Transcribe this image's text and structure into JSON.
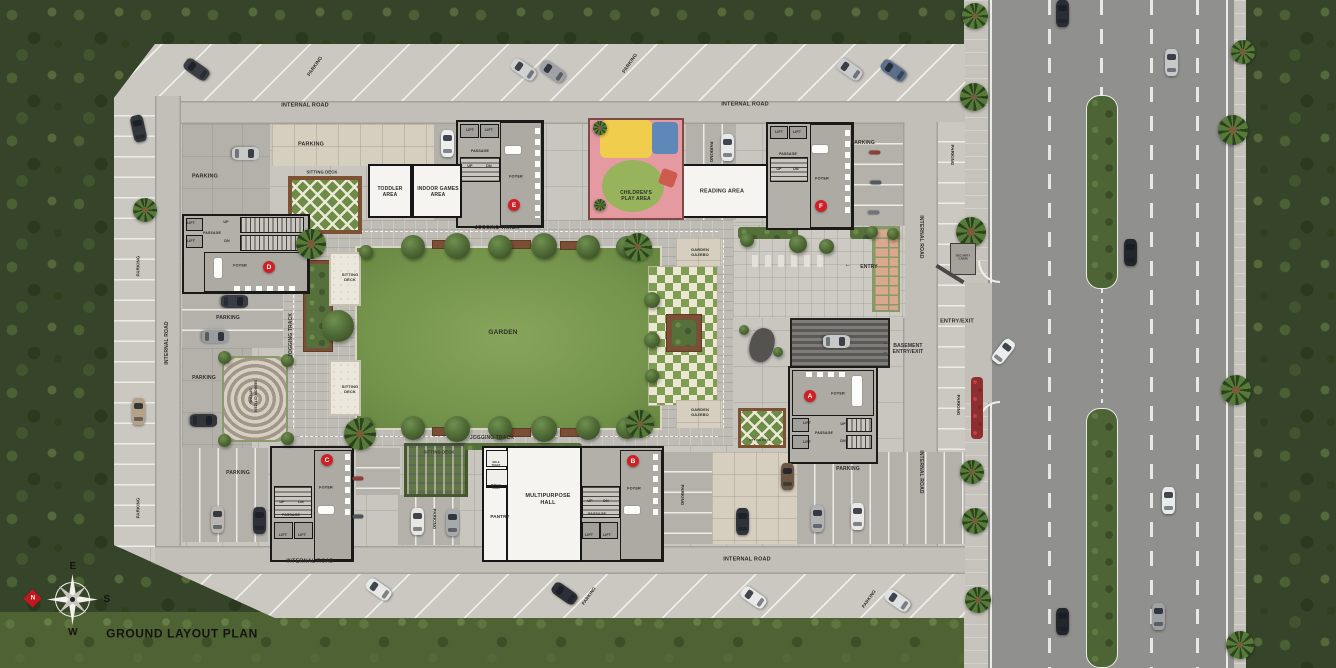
{
  "plan_title": "GROUND LAYOUT PLAN",
  "colors": {
    "badge_red": "#ce2127",
    "garden_green": "#7f9d52",
    "road_gray": "#90908e"
  },
  "blocks": [
    "A",
    "B",
    "C",
    "D",
    "E",
    "F"
  ],
  "labels": [
    {
      "t": "PARKING",
      "x": 316,
      "y": 67,
      "r": -55,
      "s": 4.8,
      "n": "label-parking"
    },
    {
      "t": "PARKING",
      "x": 631,
      "y": 64,
      "r": -55,
      "s": 4.8,
      "n": "label-parking"
    },
    {
      "t": "INTERNAL ROAD",
      "x": 305,
      "y": 106,
      "s": 5.5,
      "n": "label-internal-road"
    },
    {
      "t": "INTERNAL ROAD",
      "x": 745,
      "y": 105,
      "s": 5.5,
      "n": "label-internal-road"
    },
    {
      "t": "PARKING",
      "x": 205,
      "y": 177,
      "s": 5.5,
      "n": "label-parking"
    },
    {
      "t": "PARKING",
      "x": 311,
      "y": 145,
      "s": 5.5,
      "n": "label-parking"
    },
    {
      "t": "SITTING DECK",
      "x": 322,
      "y": 172,
      "s": 4.2,
      "n": "label-sitting-deck"
    },
    {
      "t": "TODDLER\nAREA",
      "x": 390,
      "y": 192,
      "s": 5,
      "n": "label-toddler-area"
    },
    {
      "t": "INDOOR GAMES\nAREA",
      "x": 438,
      "y": 192,
      "s": 5,
      "n": "label-indoor-games-area"
    },
    {
      "t": "LIFT",
      "x": 470,
      "y": 130,
      "s": 3.6,
      "n": "label-lift"
    },
    {
      "t": "LIFT",
      "x": 489,
      "y": 130,
      "s": 3.6,
      "n": "label-lift"
    },
    {
      "t": "PASSAGE",
      "x": 480,
      "y": 151,
      "s": 3.6,
      "n": "label-passage"
    },
    {
      "t": "UP",
      "x": 470,
      "y": 166,
      "s": 3.6,
      "n": "label-up"
    },
    {
      "t": "DN",
      "x": 489,
      "y": 166,
      "s": 3.6,
      "n": "label-dn"
    },
    {
      "t": "FOYER",
      "x": 516,
      "y": 177,
      "s": 3.8,
      "n": "label-foyer"
    },
    {
      "t": "JOGGING TRACK",
      "x": 497,
      "y": 228,
      "s": 5,
      "n": "label-jogging-track"
    },
    {
      "t": "CHILDREN'S\nPLAY AREA",
      "x": 636,
      "y": 196,
      "s": 5,
      "n": "label-childrens-play-area"
    },
    {
      "t": "PARKING",
      "x": 711,
      "y": 152,
      "r": 90,
      "s": 4.4,
      "n": "label-parking"
    },
    {
      "t": "READING AREA",
      "x": 722,
      "y": 192,
      "s": 5.5,
      "n": "label-reading-area"
    },
    {
      "t": "LIFT",
      "x": 779,
      "y": 132,
      "s": 3.6,
      "n": "label-lift"
    },
    {
      "t": "LIFT",
      "x": 797,
      "y": 132,
      "s": 3.6,
      "n": "label-lift"
    },
    {
      "t": "PASSAGE",
      "x": 788,
      "y": 154,
      "s": 3.6,
      "n": "label-passage"
    },
    {
      "t": "UP",
      "x": 779,
      "y": 169,
      "s": 3.6,
      "n": "label-up"
    },
    {
      "t": "DN",
      "x": 796,
      "y": 169,
      "s": 3.6,
      "n": "label-dn"
    },
    {
      "t": "FOYER",
      "x": 822,
      "y": 179,
      "s": 3.8,
      "n": "label-foyer"
    },
    {
      "t": "PARKING",
      "x": 863,
      "y": 143,
      "s": 5,
      "n": "label-parking"
    },
    {
      "t": "PARKING",
      "x": 952,
      "y": 155,
      "r": 90,
      "s": 4.4,
      "n": "label-parking"
    },
    {
      "t": "INTERNAL ROAD",
      "x": 921,
      "y": 237,
      "r": 90,
      "s": 5,
      "n": "label-internal-road"
    },
    {
      "t": "SECURITY\nCABIN",
      "x": 963,
      "y": 258,
      "s": 2.8,
      "n": "label-security-cabin"
    },
    {
      "t": "←",
      "x": 848,
      "y": 266,
      "s": 7,
      "n": "entry-arrow"
    },
    {
      "t": "ENTRY",
      "x": 869,
      "y": 267,
      "s": 5,
      "n": "label-entry"
    },
    {
      "t": "ENTRY/EXIT",
      "x": 957,
      "y": 322,
      "s": 5.5,
      "n": "label-entry-exit"
    },
    {
      "t": "BASEMENT\nENTRY/EXIT",
      "x": 908,
      "y": 349,
      "s": 5,
      "n": "label-basement-entry-exit"
    },
    {
      "t": "←",
      "x": 886,
      "y": 344,
      "s": 6,
      "n": "basement-arrow"
    },
    {
      "t": "←",
      "x": 886,
      "y": 353,
      "s": 6,
      "n": "basement-arrow"
    },
    {
      "t": "FOYER",
      "x": 838,
      "y": 394,
      "s": 3.8,
      "n": "label-foyer"
    },
    {
      "t": "LIFT",
      "x": 807,
      "y": 423,
      "s": 3.6,
      "n": "label-lift"
    },
    {
      "t": "LIFT",
      "x": 807,
      "y": 442,
      "s": 3.6,
      "n": "label-lift"
    },
    {
      "t": "PASSAGE",
      "x": 824,
      "y": 433,
      "s": 3.6,
      "n": "label-passage"
    },
    {
      "t": "UP",
      "x": 843,
      "y": 424,
      "s": 3.6,
      "n": "label-up"
    },
    {
      "t": "DN",
      "x": 843,
      "y": 441,
      "s": 3.6,
      "n": "label-dn"
    },
    {
      "t": "PARKING",
      "x": 848,
      "y": 469,
      "s": 5,
      "n": "label-parking"
    },
    {
      "t": "INTERNAL ROAD",
      "x": 921,
      "y": 472,
      "r": 90,
      "s": 5,
      "n": "label-internal-road"
    },
    {
      "t": "PARKING",
      "x": 958,
      "y": 405,
      "r": 90,
      "s": 4.4,
      "n": "label-parking"
    },
    {
      "t": "GARDEN",
      "x": 503,
      "y": 333,
      "s": 6.5,
      "n": "label-garden"
    },
    {
      "t": "GARDEN\nGAZEBO",
      "x": 700,
      "y": 252,
      "s": 4,
      "n": "label-garden-gazebo"
    },
    {
      "t": "GARDEN\nGAZEBO",
      "x": 700,
      "y": 412,
      "s": 4,
      "n": "label-garden-gazebo"
    },
    {
      "t": "SITTING\nDECK",
      "x": 350,
      "y": 277,
      "s": 4,
      "n": "label-sitting-deck"
    },
    {
      "t": "SITTING\nDECK",
      "x": 350,
      "y": 389,
      "s": 4,
      "n": "label-sitting-deck"
    },
    {
      "t": "JOGGING TRACK",
      "x": 291,
      "y": 335,
      "r": -90,
      "s": 5,
      "n": "label-jogging-track"
    },
    {
      "t": "JOGGING TRACK",
      "x": 492,
      "y": 438,
      "s": 5,
      "n": "label-jogging-track"
    },
    {
      "t": "SITTING DECK",
      "x": 760,
      "y": 441,
      "s": 3,
      "n": "label-sitting-deck"
    },
    {
      "t": "LIFT",
      "x": 191,
      "y": 223,
      "s": 3.6,
      "n": "label-lift"
    },
    {
      "t": "UP",
      "x": 226,
      "y": 222,
      "s": 3.6,
      "n": "label-up"
    },
    {
      "t": "PASSAGE",
      "x": 212,
      "y": 233,
      "s": 3.6,
      "n": "label-passage"
    },
    {
      "t": "LIFT",
      "x": 191,
      "y": 241,
      "s": 3.6,
      "n": "label-lift"
    },
    {
      "t": "DN",
      "x": 227,
      "y": 241,
      "s": 3.6,
      "n": "label-dn"
    },
    {
      "t": "FOYER",
      "x": 240,
      "y": 266,
      "s": 3.8,
      "n": "label-foyer"
    },
    {
      "t": "PARKING",
      "x": 228,
      "y": 318,
      "s": 5,
      "n": "label-parking"
    },
    {
      "t": "PARKING",
      "x": 204,
      "y": 378,
      "s": 5,
      "n": "label-parking"
    },
    {
      "t": "SENIOR CITIZEN\nSITTING",
      "x": 253,
      "y": 396,
      "r": 90,
      "s": 3.8,
      "n": "label-senior-citizen-sitting"
    },
    {
      "t": "PARKING",
      "x": 138,
      "y": 266,
      "r": -90,
      "s": 4.4,
      "n": "label-parking"
    },
    {
      "t": "PARKING",
      "x": 138,
      "y": 508,
      "r": -90,
      "s": 4.4,
      "n": "label-parking"
    },
    {
      "t": "INTERNAL ROAD",
      "x": 167,
      "y": 343,
      "r": -90,
      "s": 5,
      "n": "label-internal-road"
    },
    {
      "t": "PARKING",
      "x": 238,
      "y": 473,
      "s": 5,
      "n": "label-parking"
    },
    {
      "t": "FOYER",
      "x": 326,
      "y": 488,
      "s": 3.8,
      "n": "label-foyer"
    },
    {
      "t": "UP",
      "x": 282,
      "y": 502,
      "s": 3.6,
      "n": "label-up"
    },
    {
      "t": "DN",
      "x": 301,
      "y": 502,
      "s": 3.6,
      "n": "label-dn"
    },
    {
      "t": "PASSAGE",
      "x": 291,
      "y": 515,
      "s": 3.6,
      "n": "label-passage"
    },
    {
      "t": "LIFT",
      "x": 283,
      "y": 535,
      "s": 3.6,
      "n": "label-lift"
    },
    {
      "t": "LIFT",
      "x": 302,
      "y": 535,
      "s": 3.6,
      "n": "label-lift"
    },
    {
      "t": "SITTING DECK",
      "x": 439,
      "y": 452,
      "s": 4.2,
      "n": "label-sitting-deck"
    },
    {
      "t": "PARKING",
      "x": 434,
      "y": 519,
      "r": 90,
      "s": 4.4,
      "n": "label-parking"
    },
    {
      "t": "PANTRY",
      "x": 500,
      "y": 517,
      "s": 4.6,
      "n": "label-pantry"
    },
    {
      "t": "MALE\nTOILET",
      "x": 496,
      "y": 464,
      "s": 2.4,
      "n": "label-male-toilet"
    },
    {
      "t": "FEMALE\nTOILET",
      "x": 496,
      "y": 487,
      "s": 2.4,
      "n": "label-female-toilet"
    },
    {
      "t": "MULTIPURPOSE\nHALL",
      "x": 548,
      "y": 500,
      "s": 5.5,
      "n": "label-multipurpose-hall"
    },
    {
      "t": "INTERNAL ROAD",
      "x": 310,
      "y": 562,
      "s": 5.5,
      "n": "label-internal-road"
    },
    {
      "t": "INTERNAL ROAD",
      "x": 747,
      "y": 560,
      "s": 5.5,
      "n": "label-internal-road"
    },
    {
      "t": "FOYER",
      "x": 634,
      "y": 489,
      "s": 3.8,
      "n": "label-foyer"
    },
    {
      "t": "UP",
      "x": 590,
      "y": 501,
      "s": 3.6,
      "n": "label-up"
    },
    {
      "t": "DN",
      "x": 606,
      "y": 501,
      "s": 3.6,
      "n": "label-dn"
    },
    {
      "t": "PASSAGE",
      "x": 597,
      "y": 514,
      "s": 3.6,
      "n": "label-passage"
    },
    {
      "t": "LIFT",
      "x": 589,
      "y": 535,
      "s": 3.6,
      "n": "label-lift"
    },
    {
      "t": "LIFT",
      "x": 607,
      "y": 535,
      "s": 3.6,
      "n": "label-lift"
    },
    {
      "t": "PARKING",
      "x": 682,
      "y": 495,
      "r": 90,
      "s": 4.4,
      "n": "label-parking"
    },
    {
      "t": "PARKING",
      "x": 589,
      "y": 596,
      "r": -55,
      "s": 4.4,
      "n": "label-parking"
    },
    {
      "t": "PARKING",
      "x": 869,
      "y": 599,
      "r": -55,
      "s": 4.4,
      "n": "label-parking"
    },
    {
      "t": "GROUND LAYOUT PLAN",
      "x": 182,
      "y": 634,
      "s": 12,
      "w": 800,
      "c": "#141414",
      "ls": 0.6,
      "n": "plan-title"
    },
    {
      "t": "E",
      "x": 73,
      "y": 567,
      "s": 10,
      "c": "#15130f",
      "n": "compass-e"
    },
    {
      "t": "S",
      "x": 107,
      "y": 600,
      "s": 10,
      "c": "#15130f",
      "n": "compass-s"
    },
    {
      "t": "W",
      "x": 73,
      "y": 633,
      "s": 10,
      "c": "#15130f",
      "n": "compass-w"
    },
    {
      "t": "N",
      "x": 33,
      "y": 599,
      "s": 6,
      "c": "#ffffff",
      "n": "compass-n"
    }
  ],
  "badges": [
    {
      "l": "A",
      "x": 810,
      "y": 396
    },
    {
      "l": "B",
      "x": 633,
      "y": 461
    },
    {
      "l": "C",
      "x": 327,
      "y": 460
    },
    {
      "l": "D",
      "x": 269,
      "y": 267
    },
    {
      "l": "E",
      "x": 514,
      "y": 205
    },
    {
      "l": "F",
      "x": 821,
      "y": 206
    }
  ],
  "cars": [
    [
      196,
      69,
      -55,
      "#3a3d42"
    ],
    [
      523,
      69,
      -55,
      "#cfd1d2"
    ],
    [
      552,
      71,
      -55,
      "#9fa2a6"
    ],
    [
      849,
      69,
      -55,
      "#c9cbcc"
    ],
    [
      893,
      70,
      -55,
      "#5b6f8a"
    ],
    [
      138,
      128,
      -12,
      "#33363b"
    ],
    [
      138,
      411,
      0,
      "#b5a286"
    ],
    [
      245,
      153,
      90,
      "#c8c9c9"
    ],
    [
      447,
      143,
      0,
      "#eceeee"
    ],
    [
      727,
      147,
      0,
      "#e8e9e9"
    ],
    [
      234,
      301,
      90,
      "#3a3e44"
    ],
    [
      215,
      336,
      90,
      "#9a9d9f"
    ],
    [
      203,
      420,
      90,
      "#32363b"
    ],
    [
      217,
      519,
      0,
      "#b9b6b1"
    ],
    [
      259,
      520,
      0,
      "#2e3238"
    ],
    [
      417,
      521,
      0,
      "#e8e7e4"
    ],
    [
      452,
      522,
      0,
      "#a7a9ab"
    ],
    [
      742,
      521,
      0,
      "#2f3339"
    ],
    [
      787,
      476,
      0,
      "#6b5744"
    ],
    [
      817,
      518,
      0,
      "#b0b2b4"
    ],
    [
      857,
      516,
      0,
      "#e9e8e5"
    ],
    [
      836,
      341,
      90,
      "#c7c8c9"
    ],
    [
      378,
      589,
      -55,
      "#e6e7e7"
    ],
    [
      564,
      593,
      -55,
      "#2c3036"
    ],
    [
      753,
      597,
      -55,
      "#e9e9e8"
    ],
    [
      897,
      600,
      -55,
      "#dfe0e0"
    ],
    [
      1062,
      13,
      0,
      "#2a2d33"
    ],
    [
      1171,
      62,
      0,
      "#c6c8ca"
    ],
    [
      1130,
      252,
      0,
      "#23262b"
    ],
    [
      1003,
      351,
      38,
      "#eceded"
    ],
    [
      1168,
      500,
      0,
      "#e9eaea"
    ],
    [
      1062,
      621,
      0,
      "#23262b"
    ],
    [
      1158,
      616,
      0,
      "#9ea1a4"
    ],
    [
      875,
      152,
      90,
      "#8a4036",
      "b"
    ],
    [
      876,
      182,
      90,
      "#555a60",
      "b"
    ],
    [
      874,
      212,
      90,
      "#70737a",
      "b"
    ],
    [
      358,
      478,
      90,
      "#8a4036",
      "b"
    ],
    [
      358,
      516,
      90,
      "#50545a",
      "b"
    ]
  ],
  "trees": [
    [
      413,
      247,
      24
    ],
    [
      457,
      246,
      26
    ],
    [
      500,
      247,
      24
    ],
    [
      544,
      246,
      26
    ],
    [
      588,
      247,
      24
    ],
    [
      627,
      247,
      22
    ],
    [
      413,
      428,
      24
    ],
    [
      457,
      429,
      26
    ],
    [
      500,
      428,
      24
    ],
    [
      544,
      429,
      26
    ],
    [
      588,
      428,
      24
    ],
    [
      627,
      428,
      22
    ],
    [
      652,
      300,
      16
    ],
    [
      652,
      340,
      16
    ],
    [
      652,
      376,
      14
    ],
    [
      366,
      252,
      14
    ],
    [
      366,
      424,
      14
    ],
    [
      338,
      326,
      32
    ],
    [
      224,
      357,
      13
    ],
    [
      287,
      360,
      13
    ],
    [
      224,
      440,
      13
    ],
    [
      287,
      438,
      13
    ],
    [
      798,
      244,
      18
    ],
    [
      826,
      246,
      15
    ],
    [
      747,
      240,
      14
    ],
    [
      872,
      232,
      12
    ],
    [
      893,
      234,
      12
    ],
    [
      744,
      330,
      10
    ],
    [
      778,
      352,
      10
    ]
  ],
  "palms": [
    [
      311,
      244,
      30
    ],
    [
      360,
      434,
      32
    ],
    [
      638,
      247,
      28
    ],
    [
      640,
      424,
      28
    ],
    [
      145,
      210,
      24
    ],
    [
      600,
      128,
      14
    ],
    [
      600,
      205,
      12
    ],
    [
      975,
      16,
      26
    ],
    [
      974,
      97,
      28
    ],
    [
      971,
      232,
      30
    ],
    [
      972,
      472,
      24
    ],
    [
      975,
      521,
      26
    ],
    [
      978,
      600,
      26
    ],
    [
      1233,
      130,
      30
    ],
    [
      1236,
      390,
      30
    ],
    [
      1240,
      645,
      28
    ],
    [
      1243,
      52,
      24
    ]
  ]
}
